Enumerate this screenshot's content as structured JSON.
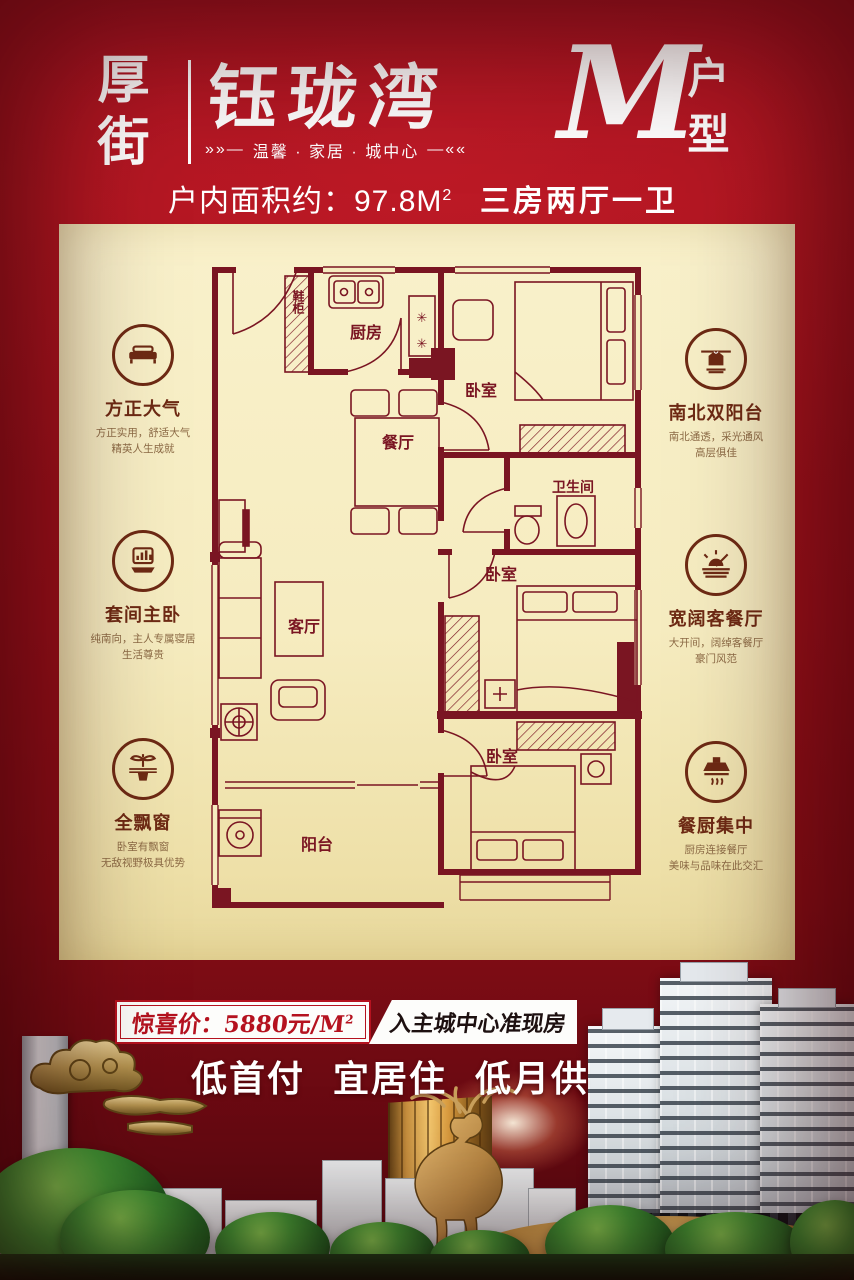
{
  "header": {
    "logo": "厚街",
    "brand": "钰珑湾",
    "tagline_prefix": "»»—",
    "tagline": "温馨 · 家居 · 城中心",
    "tagline_suffix": "—««",
    "unit_letter": "M",
    "unit_type": "户型",
    "area_label": "户内面积约：97.8M",
    "area_sup": "2",
    "rooms_summary": "三房两厅一卫"
  },
  "floorplan": {
    "labels": {
      "shoe_cabinet": "鞋柜",
      "kitchen": "厨房",
      "bedroom_top": "卧室",
      "dining": "餐厅",
      "bathroom": "卫生间",
      "living": "客厅",
      "bedroom_middle": "卧室",
      "bedroom_bottom": "卧室",
      "balcony": "阳台",
      "stove_mark": "✳"
    }
  },
  "features_left": [
    {
      "icon": "sofa-icon",
      "title": "方正大气",
      "desc1": "方正实用，舒适大气",
      "desc2": "精英人生成就"
    },
    {
      "icon": "chart-icon",
      "title": "套间主卧",
      "desc1": "纯南向，主人专属寝居",
      "desc2": "生活尊贵"
    },
    {
      "icon": "tree-icon",
      "title": "全飘窗",
      "desc1": "卧室有飘窗",
      "desc2": "无敌视野极具优势"
    }
  ],
  "features_right": [
    {
      "icon": "shirt-icon",
      "title": "南北双阳台",
      "desc1": "南北通透，采光通风",
      "desc2": "高层俱佳"
    },
    {
      "icon": "sunrise-icon",
      "title": "宽阔客餐厅",
      "desc1": "大开间，阔绰客餐厅",
      "desc2": "豪门风范"
    },
    {
      "icon": "hood-icon",
      "title": "餐厨集中",
      "desc1": "厨房连接餐厅",
      "desc2": "美味与品味在此交汇"
    }
  ],
  "footer": {
    "price_prefix": "惊喜价：",
    "price_value": "5880",
    "price_unit": "元/M",
    "price_sup": "2",
    "ribbon_text": "入主城中心准现房",
    "slogan1": "低首付",
    "slogan2": "宜居住",
    "slogan3": "低月供"
  },
  "colors": {
    "background_red": "#a31220",
    "deep_red": "#6d0a12",
    "panel_cream": "#f6ecc0",
    "plan_line": "#7a1522",
    "accent_red": "#b5121f",
    "gold": "#c79a55",
    "white": "#ffffff"
  }
}
